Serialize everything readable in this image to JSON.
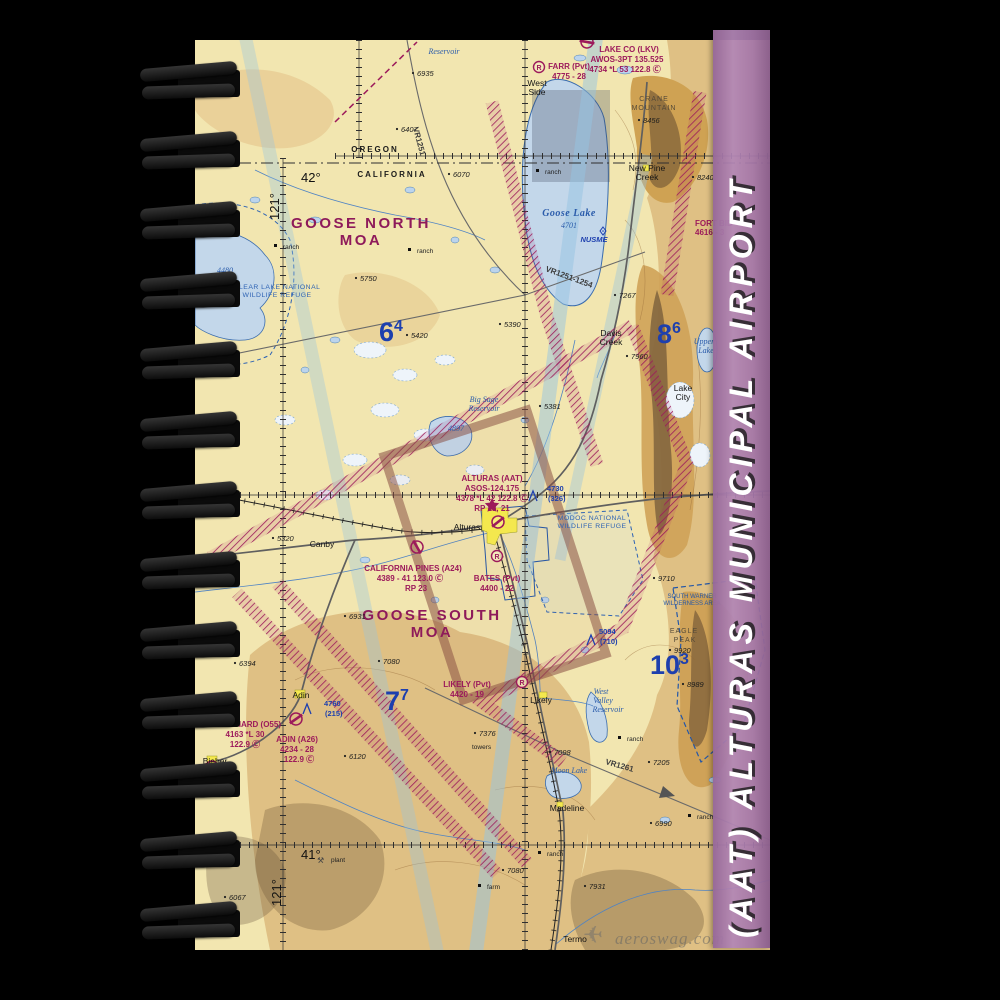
{
  "strip": {
    "title": "(AAT) ALTURAS MUNICIPAL AIRPORT",
    "color": "#a77aac"
  },
  "watermark": {
    "text": "aeroswag.com",
    "plane_icon": "✈"
  },
  "chart": {
    "colors": {
      "land_cream": "#f2e6b0",
      "terrain_tan": "#dfc084",
      "terrain_dark": "#cfa258",
      "water_blue": "#c3d7ea",
      "aero_magenta": "#9c1a5b",
      "aero_blue": "#1d3fae",
      "moa_magenta": "#8e1a5a"
    },
    "labels": [
      {
        "t": "Reservoir",
        "x": 249,
        "y": 14,
        "c": "water"
      },
      {
        "t": "6935",
        "x": 222,
        "y": 36,
        "c": "elev"
      },
      {
        "t": "6407",
        "x": 206,
        "y": 92,
        "c": "elev"
      },
      {
        "t": "VR1251",
        "x": 218,
        "y": 88,
        "c": "vr",
        "rot": 75
      },
      {
        "t": "West",
        "x": 342,
        "y": 46,
        "c": "town"
      },
      {
        "t": "Side",
        "x": 342,
        "y": 55,
        "c": "town"
      },
      {
        "t": "FARR (Pvt)",
        "x": 374,
        "y": 29,
        "c": "apt"
      },
      {
        "t": "4775 - 28",
        "x": 374,
        "y": 39,
        "c": "apt"
      },
      {
        "t": "R",
        "x": 344,
        "y": 30,
        "c": "rsym"
      },
      {
        "t": "LAKE CO (LKV)",
        "x": 434,
        "y": 12,
        "c": "apt"
      },
      {
        "t": "AWOS-3PT 135.525",
        "x": 432,
        "y": 22,
        "c": "apt"
      },
      {
        "t": "4734 *L 53 122.8 Ⓒ",
        "x": 430,
        "y": 32,
        "c": "apt"
      },
      {
        "t": "CRANE",
        "x": 459,
        "y": 61,
        "c": "mtn"
      },
      {
        "t": "MOUNTAIN",
        "x": 459,
        "y": 70,
        "c": "mtn"
      },
      {
        "t": "8456",
        "x": 448,
        "y": 83,
        "c": "elev"
      },
      {
        "t": "New Pine",
        "x": 452,
        "y": 131,
        "c": "town"
      },
      {
        "t": "Creek",
        "x": 452,
        "y": 140,
        "c": "town"
      },
      {
        "t": "8240",
        "x": 502,
        "y": 140,
        "c": "elev"
      },
      {
        "t": "FORT BID",
        "x": 500,
        "y": 186,
        "c": "aptl"
      },
      {
        "t": "4616 - 3",
        "x": 500,
        "y": 195,
        "c": "aptl"
      },
      {
        "t": "OREGON",
        "x": 180,
        "y": 112,
        "c": "state"
      },
      {
        "t": "CALIFORNIA",
        "x": 197,
        "y": 137,
        "c": "state"
      },
      {
        "t": "6070",
        "x": 258,
        "y": 137,
        "c": "elev"
      },
      {
        "t": "42°",
        "x": 106,
        "y": 142,
        "c": "coord"
      },
      {
        "t": "121°",
        "x": 84,
        "y": 180,
        "c": "coord",
        "rot": -90
      },
      {
        "t": "GOOSE NORTH",
        "x": 166,
        "y": 188,
        "c": "moa"
      },
      {
        "t": "MOA",
        "x": 166,
        "y": 205,
        "c": "moa"
      },
      {
        "t": "ranch",
        "x": 88,
        "y": 209,
        "c": "ranch",
        "m": "sq"
      },
      {
        "t": "ranch",
        "x": 222,
        "y": 213,
        "c": "ranch",
        "m": "sq"
      },
      {
        "t": "ranch",
        "x": 350,
        "y": 134,
        "c": "ranch",
        "m": "sq"
      },
      {
        "t": "5750",
        "x": 165,
        "y": 241,
        "c": "elev"
      },
      {
        "t": "Goose Lake",
        "x": 374,
        "y": 176,
        "c": "waterb"
      },
      {
        "t": "4701",
        "x": 374,
        "y": 188,
        "c": "water"
      },
      {
        "t": "NUSME",
        "x": 399,
        "y": 202,
        "c": "fix"
      },
      {
        "t": "VR1251-1254",
        "x": 350,
        "y": 231,
        "c": "vr",
        "rot": 20
      },
      {
        "t": "CLEAR LAKE NATIONAL",
        "x": 82,
        "y": 249,
        "c": "area"
      },
      {
        "t": "WILDLIFE REFUGE",
        "x": 82,
        "y": 257,
        "c": "area"
      },
      {
        "t": "4480",
        "x": 30,
        "y": 233,
        "c": "water"
      },
      {
        "t": "7267",
        "x": 424,
        "y": 258,
        "c": "elev"
      },
      {
        "t": "Davis",
        "x": 416,
        "y": 296,
        "c": "town"
      },
      {
        "t": "Creek",
        "x": 416,
        "y": 305,
        "c": "town"
      },
      {
        "t": "7960",
        "x": 436,
        "y": 319,
        "c": "elev"
      },
      {
        "t": "Lake",
        "x": 488,
        "y": 351,
        "c": "town"
      },
      {
        "t": "City",
        "x": 488,
        "y": 360,
        "c": "town"
      },
      {
        "t": "Upper",
        "x": 509,
        "y": 304,
        "c": "water"
      },
      {
        "t": "Lake",
        "x": 511,
        "y": 313,
        "c": "water"
      },
      {
        "t": "5420",
        "x": 216,
        "y": 298,
        "c": "elev"
      },
      {
        "t": "5390",
        "x": 309,
        "y": 287,
        "c": "elev"
      },
      {
        "t": "5381",
        "x": 349,
        "y": 369,
        "c": "elev"
      },
      {
        "t": "Big Sage",
        "x": 289,
        "y": 362,
        "c": "water"
      },
      {
        "t": "Reservoir",
        "x": 289,
        "y": 371,
        "c": "water"
      },
      {
        "t": "4897",
        "x": 261,
        "y": 391,
        "c": "water"
      },
      {
        "t": "6",
        "sup": "4",
        "x": 184,
        "y": 301,
        "c": "mef"
      },
      {
        "t": "8",
        "sup": "6",
        "x": 462,
        "y": 303,
        "c": "mef"
      },
      {
        "t": "ALTURAS (AAT)",
        "x": 297,
        "y": 441,
        "c": "apt"
      },
      {
        "t": "ASOS-124.175",
        "x": 297,
        "y": 451,
        "c": "apt"
      },
      {
        "t": "4378 *L 42 122.8 Ⓒ",
        "x": 297,
        "y": 461,
        "c": "apt"
      },
      {
        "t": "RP 13, 21",
        "x": 297,
        "y": 471,
        "c": "apt"
      },
      {
        "t": "4730",
        "x": 352,
        "y": 451,
        "c": "obst"
      },
      {
        "t": "(326)",
        "x": 353,
        "y": 461,
        "c": "obst"
      },
      {
        "t": "Alturas",
        "x": 272,
        "y": 490,
        "c": "town"
      },
      {
        "t": "MODOC NATIONAL",
        "x": 397,
        "y": 480,
        "c": "area"
      },
      {
        "t": "WILDLIFE REFUGE",
        "x": 397,
        "y": 488,
        "c": "area"
      },
      {
        "t": "5320",
        "x": 82,
        "y": 501,
        "c": "elev"
      },
      {
        "t": "Canby",
        "x": 127,
        "y": 507,
        "c": "town"
      },
      {
        "t": "R",
        "x": 302,
        "y": 519,
        "c": "rsym"
      },
      {
        "t": "BATES (Pvt)",
        "x": 302,
        "y": 541,
        "c": "apt"
      },
      {
        "t": "4400 - 22",
        "x": 302,
        "y": 551,
        "c": "apt"
      },
      {
        "t": "CALIFORNIA PINES (A24)",
        "x": 218,
        "y": 531,
        "c": "apt"
      },
      {
        "t": "4389 - 41 123.0 Ⓒ",
        "x": 215,
        "y": 541,
        "c": "apt"
      },
      {
        "t": "RP 23",
        "x": 221,
        "y": 551,
        "c": "apt"
      },
      {
        "t": "GOOSE SOUTH",
        "x": 237,
        "y": 580,
        "c": "moa"
      },
      {
        "t": "MOA",
        "x": 237,
        "y": 597,
        "c": "moa"
      },
      {
        "t": "6931",
        "x": 154,
        "y": 579,
        "c": "elev"
      },
      {
        "t": "7080",
        "x": 188,
        "y": 624,
        "c": "elev"
      },
      {
        "t": "SOUTH WARNER",
        "x": 497,
        "y": 558,
        "c": "wild"
      },
      {
        "t": "WILDERNESS AREA",
        "x": 497,
        "y": 565,
        "c": "wild"
      },
      {
        "t": "9710",
        "x": 463,
        "y": 541,
        "c": "elev"
      },
      {
        "t": "EAGLE",
        "x": 489,
        "y": 593,
        "c": "mtn"
      },
      {
        "t": "PEAK",
        "x": 490,
        "y": 602,
        "c": "mtn"
      },
      {
        "t": "9920",
        "x": 479,
        "y": 613,
        "c": "elev"
      },
      {
        "t": "10",
        "sup": "3",
        "x": 455,
        "y": 634,
        "c": "mef"
      },
      {
        "t": "8989",
        "x": 492,
        "y": 647,
        "c": "elev"
      },
      {
        "t": "5094",
        "x": 404,
        "y": 594,
        "c": "obst"
      },
      {
        "t": "(710)",
        "x": 405,
        "y": 604,
        "c": "obst"
      },
      {
        "t": "7",
        "sup": "7",
        "x": 190,
        "y": 670,
        "c": "mef"
      },
      {
        "t": "LIKELY (Pvt)",
        "x": 272,
        "y": 647,
        "c": "apt"
      },
      {
        "t": "4420 - 19",
        "x": 272,
        "y": 657,
        "c": "apt"
      },
      {
        "t": "R",
        "x": 327,
        "y": 645,
        "c": "rsym"
      },
      {
        "t": "Likely",
        "x": 346,
        "y": 663,
        "c": "town"
      },
      {
        "t": "West",
        "x": 406,
        "y": 654,
        "c": "water"
      },
      {
        "t": "Valley",
        "x": 408,
        "y": 663,
        "c": "water"
      },
      {
        "t": "Reservoir",
        "x": 413,
        "y": 672,
        "c": "water"
      },
      {
        "t": "6394",
        "x": 44,
        "y": 626,
        "c": "elev"
      },
      {
        "t": "Adin",
        "x": 106,
        "y": 658,
        "c": "town"
      },
      {
        "t": "4760",
        "x": 129,
        "y": 666,
        "c": "obst"
      },
      {
        "t": "(215)",
        "x": 130,
        "y": 676,
        "c": "obst"
      },
      {
        "t": "SOUTHARD (O55)",
        "x": 52,
        "y": 687,
        "c": "apt"
      },
      {
        "t": "4163 *L 30",
        "x": 50,
        "y": 697,
        "c": "apt"
      },
      {
        "t": "122.9 Ⓒ",
        "x": 50,
        "y": 707,
        "c": "apt"
      },
      {
        "t": "ADIN (A26)",
        "x": 102,
        "y": 702,
        "c": "apt"
      },
      {
        "t": "4234 - 28",
        "x": 102,
        "y": 712,
        "c": "apt"
      },
      {
        "t": "122.9 Ⓒ",
        "x": 104,
        "y": 722,
        "c": "apt"
      },
      {
        "t": "Bieber",
        "x": 20,
        "y": 724,
        "c": "town"
      },
      {
        "t": "6120",
        "x": 154,
        "y": 719,
        "c": "elev"
      },
      {
        "t": "7376",
        "x": 284,
        "y": 696,
        "c": "elev"
      },
      {
        "t": "towers",
        "x": 277,
        "y": 709,
        "c": "ranch"
      },
      {
        "t": "7098",
        "x": 359,
        "y": 715,
        "c": "elev"
      },
      {
        "t": "Moon Lake",
        "x": 374,
        "y": 733,
        "c": "water"
      },
      {
        "t": "VR1261",
        "x": 410,
        "y": 724,
        "c": "vr",
        "rot": 16
      },
      {
        "t": "7205",
        "x": 458,
        "y": 725,
        "c": "elev"
      },
      {
        "t": "ranch",
        "x": 432,
        "y": 701,
        "c": "ranch",
        "m": "sq"
      },
      {
        "t": "Madeline",
        "x": 372,
        "y": 771,
        "c": "town"
      },
      {
        "t": "6990",
        "x": 460,
        "y": 786,
        "c": "elev"
      },
      {
        "t": "ranch",
        "x": 502,
        "y": 779,
        "c": "ranch",
        "m": "sq"
      },
      {
        "t": "ranch",
        "x": 352,
        "y": 816,
        "c": "ranch",
        "m": "sq"
      },
      {
        "t": "41°",
        "x": 106,
        "y": 819,
        "c": "coord"
      },
      {
        "t": "121°",
        "x": 86,
        "y": 866,
        "c": "coord",
        "rot": -90
      },
      {
        "t": "plant",
        "x": 136,
        "y": 822,
        "c": "ranch"
      },
      {
        "t": "⚒",
        "x": 122,
        "y": 823,
        "c": "sym"
      },
      {
        "t": "6067",
        "x": 34,
        "y": 860,
        "c": "elev"
      },
      {
        "t": "7080",
        "x": 312,
        "y": 833,
        "c": "elev"
      },
      {
        "t": "7931",
        "x": 394,
        "y": 849,
        "c": "elev"
      },
      {
        "t": "Termo",
        "x": 380,
        "y": 902,
        "c": "town"
      },
      {
        "t": "farm",
        "x": 292,
        "y": 849,
        "c": "ranch",
        "m": "sq"
      },
      {
        "t": "aeroswag.com",
        "x": 420,
        "y": 904,
        "c": "wm"
      }
    ]
  }
}
